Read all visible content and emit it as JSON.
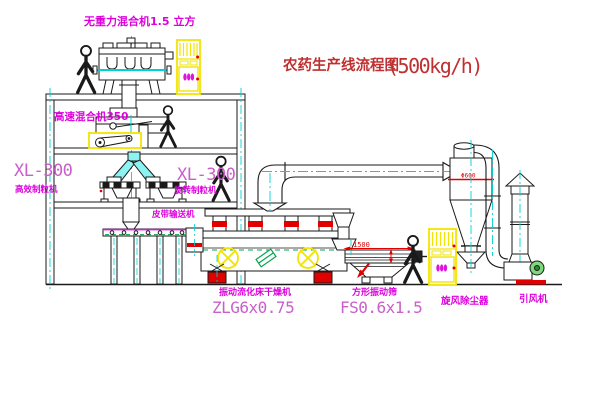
{
  "title": {
    "name": "农药生产线流程图",
    "capacity": "(500kg/h)"
  },
  "labels": {
    "gravityless_mixer": "无重力混合机1.5 立方",
    "high_speed_mixer": "高速混合机350",
    "granulator_left_model": "XL-300",
    "granulator_left_name": "高效制粒机",
    "granulator_right_model": "XL-300",
    "granulator_right_name": "旋转制粒机",
    "belt_conveyor": "皮带输送机",
    "dryer_name": "振动流化床干燥机",
    "dryer_model": "ZLG6x0.75",
    "screen_name": "方形振动筛",
    "screen_model": "FS0.6x1.5",
    "cyclone": "旋风除尘器",
    "fan": "引风机"
  },
  "dims": {
    "screen_length": "1500",
    "cyclone_diameter": "Φ600"
  },
  "colors": {
    "label_magenta": "#dd00dd",
    "model_magenta": "#c95fc9",
    "title_red": "#bf3030",
    "dimension_red": "#e00000",
    "line_black": "#1a1a1a",
    "centerline_cyan": "#00d2d2",
    "highlight_yellow": "#f2e400",
    "accent_green": "#00a550"
  }
}
